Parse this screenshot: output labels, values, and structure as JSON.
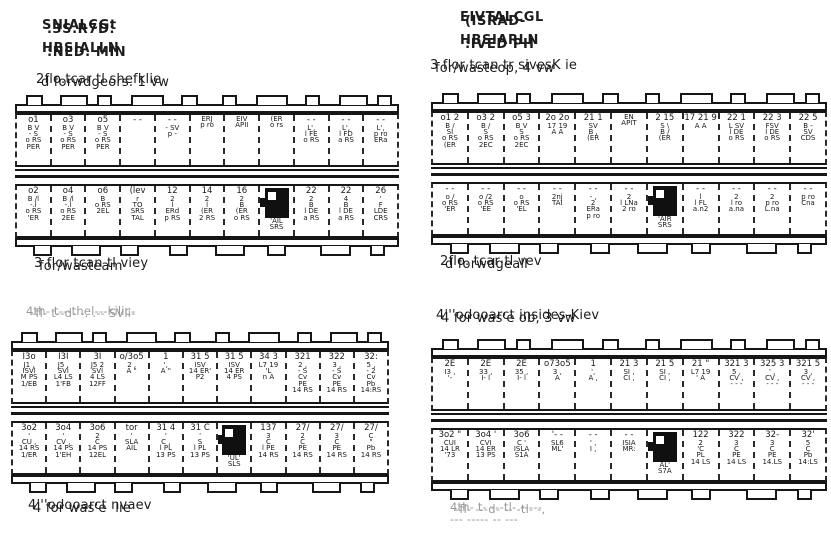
{
  "paper": "#ffffff",
  "ink": "#1c1c1c",
  "panels": [
    {
      "name": "upper-left",
      "header": [
        "SNIALCGt",
        ".3S.R7D:",
        "HBSIALLN",
        ":NED. MIN"
      ],
      "above": [
        "2flo.tcar tl shefklie",
        "d forwdgeors. 1 vw"
      ],
      "below": [
        "3 flor tcan tl viey",
        "for/wasteam"
      ],
      "rows": [
        [
          {
            "lines": [
              "o1",
              "B V",
              "- S",
              "o RS",
              "PER"
            ]
          },
          {
            "lines": [
              "o3",
              "B V",
              "- S",
              "o RS",
              "PER"
            ]
          },
          {
            "lines": [
              "o5",
              "B V",
              "- S",
              "o RS",
              "PER"
            ]
          },
          {
            "lines": [
              "- -"
            ]
          },
          {
            "lines": [
              "- -",
              "- SV",
              "p -"
            ]
          },
          {
            "lines": [
              "",
              "ERJ",
              "p ro"
            ]
          },
          {
            "lines": [
              "",
              "EIV",
              "APII"
            ]
          },
          {
            "lines": [
              "",
              "(ER",
              "o rs"
            ]
          },
          {
            "lines": [
              "- -",
              "L',",
              "l FE",
              "o RS"
            ]
          },
          {
            "lines": [
              "- -",
              "L',",
              "l FD",
              "a RS"
            ]
          },
          {
            "lines": [
              "- -",
              "L',",
              "p ro",
              "ERa"
            ]
          }
        ],
        [
          {
            "lines": [
              "o2",
              "B /l",
              "-.l",
              "o RS",
              "'ER"
            ]
          },
          {
            "lines": [
              "o4",
              "B /l",
              "-.l",
              "o RS",
              "2EE"
            ]
          },
          {
            "lines": [
              "o6",
              "B",
              "",
              "o RS",
              "2EL"
            ]
          },
          {
            "lines": [
              "(lev",
              "r",
              "TO",
              "SRS",
              "TAL"
            ]
          },
          {
            "lines": [
              "12",
              "2",
              "l",
              "ERd",
              "p RS"
            ]
          },
          {
            "lines": [
              "14",
              "2",
              "l",
              "(ER",
              "2 RS"
            ]
          },
          {
            "lines": [
              "16",
              "2",
              "B",
              "(ER",
              "o RS"
            ]
          },
          {
            "m": true,
            "lines": [
              "'AIL",
              "SRS"
            ]
          },
          {
            "lines": [
              "22",
              "2",
              "B",
              "l DE",
              "a RS"
            ]
          },
          {
            "lines": [
              "22",
              "4",
              "B",
              "l DE",
              "a RS"
            ]
          },
          {
            "lines": [
              "26",
              "'",
              "F",
              "LDE",
              "CRS"
            ]
          }
        ]
      ]
    },
    {
      "name": "upper-right",
      "header": [
        "EIVTALCGL",
        "(ISRAD-",
        "HBSIARLN",
        ":IVED PH"
      ],
      "above": [
        "3 flor tcan tr sivesK ie",
        "for/wasteop, 4 vw"
      ],
      "below": [
        "2flo. tcar tl vev",
        "d forwdgeall"
      ],
      "rows": [
        [
          {
            "lines": [
              "o1 2",
              "B /",
              "SI",
              "o RS",
              "(ER"
            ]
          },
          {
            "lines": [
              "o3 2",
              "B /",
              "S",
              "o RS",
              "2EC"
            ]
          },
          {
            "lines": [
              "o5 3",
              "B V",
              "S",
              "o RS",
              "2EC"
            ]
          },
          {
            "lines": [
              "2o 2o",
              "17 19",
              "A A"
            ]
          },
          {
            "lines": [
              "21 1",
              "SV",
              "B ,",
              "(ER"
            ]
          },
          {
            "lines": [
              "",
              "EN",
              "APIT"
            ]
          },
          {
            "lines": [
              "2 15",
              "S \\",
              "B /",
              "(ER"
            ]
          },
          {
            "lines": [
              "17 21 9",
              "A A"
            ]
          },
          {
            "lines": [
              "22 1",
              "L SV",
              "l DE",
              "o RS"
            ]
          },
          {
            "lines": [
              "22 3",
              "FSV",
              "l DE",
              "o RS"
            ]
          },
          {
            "lines": [
              "22 5",
              "B -",
              "SV",
              "CDS"
            ]
          }
        ],
        [
          {
            "lines": [
              "- -",
              "o /",
              "",
              "o RS",
              "'ER"
            ]
          },
          {
            "lines": [
              "- -",
              "o /2",
              "",
              "o RS",
              "'EE"
            ]
          },
          {
            "lines": [
              "- -",
              "o",
              "",
              "o RS",
              "'EL"
            ]
          },
          {
            "lines": [
              "- -",
              "",
              "2nj",
              "TAI"
            ]
          },
          {
            "lines": [
              "- -",
              "- ,",
              "2",
              "ERa",
              "p ro"
            ]
          },
          {
            "lines": [
              "- -",
              "2",
              "",
              "l LNa",
              "2 ro"
            ]
          },
          {
            "m": true,
            "lines": [
              "'AIR",
              "SRS"
            ]
          },
          {
            "lines": [
              "- -",
              "",
              "l",
              "l FL",
              "a.n2"
            ]
          },
          {
            "lines": [
              "- -",
              "",
              "2",
              "l ro",
              "a.na"
            ]
          },
          {
            "lines": [
              "- -",
              "",
              "2",
              "p ro",
              "L.na"
            ]
          },
          {
            "lines": [
              "- -",
              "",
              "",
              "p ro",
              "Cna"
            ]
          }
        ]
      ]
    },
    {
      "name": "lower-left",
      "header": null,
      "above": [
        "4th- t---thel---kilic-",
        "-fl- t--d- -. .-- SVli-"
      ],
      "below": [
        "4'''odooarct nvaev",
        "4 for was'e  lie"
      ],
      "rows": [
        [
          {
            "lines": [
              "I3o",
              "J1 ,",
              "ISVl",
              "M PS",
              "1/EB"
            ]
          },
          {
            "lines": [
              "I3I",
              "J5 ,",
              "SVl",
              "L4 LS",
              "1'FB"
            ]
          },
          {
            "lines": [
              "3I",
              "J5 2",
              "SVl",
              "4 LS",
              "12FF"
            ]
          },
          {
            "lines": [
              "o/3o5",
              "2 ,",
              "A \""
            ]
          },
          {
            "lines": [
              "1",
              "',",
              "A \""
            ]
          },
          {
            "lines": [
              "31 5",
              "ISV",
              "14 ER'",
              "P2"
            ]
          },
          {
            "lines": [
              "31 5",
              "ISV",
              "14 ER",
              "4 PS"
            ]
          },
          {
            "lines": [
              "34 3",
              "L7 19",
              "'L",
              "n A"
            ]
          },
          {
            "lines": [
              "321",
              "2 ,",
              "- S",
              "Cv",
              "PE",
              "14 RS"
            ]
          },
          {
            "lines": [
              "322",
              "3 ,",
              "- S",
              "Cv",
              "PE",
              "14 RS"
            ]
          },
          {
            "lines": [
              "32:",
              "5 ,",
              "- 2",
              "Cv",
              "Pb",
              "14:RS"
            ]
          }
        ],
        [
          {
            "lines": [
              "3o2",
              "'",
              "CU ,",
              "14 RS",
              "1/ER"
            ]
          },
          {
            "lines": [
              "3o4",
              "'",
              "CV ,",
              "14 PS",
              "1'EH"
            ]
          },
          {
            "lines": [
              "3o6",
              "2",
              "C",
              "14 PS",
              "12EL"
            ]
          },
          {
            "lines": [
              "tor",
              "'",
              "SLA",
              "AIL"
            ]
          },
          {
            "lines": [
              "31 4",
              "'",
              "C ,",
              "l PL",
              "13 PS"
            ]
          },
          {
            "lines": [
              "31 C",
              "'",
              "S",
              "l PL",
              "13 PS"
            ]
          },
          {
            "m": true,
            "lines": [
              "'UL'",
              "SLS"
            ]
          },
          {
            "lines": [
              "137",
              "3",
              "C",
              "l PE",
              "14 RS"
            ]
          },
          {
            "lines": [
              "27/",
              "2",
              "C",
              "PE",
              "14 RS"
            ]
          },
          {
            "lines": [
              "27/",
              "3",
              "C",
              "PE",
              "14 RS"
            ]
          },
          {
            "lines": [
              "27/",
              "C",
              "\"",
              "Pb",
              "14 RS"
            ]
          }
        ]
      ]
    },
    {
      "name": "lower-right",
      "header": null,
      "above": [
        "4'''odooarct insides-Kiev",
        "4 for was'e ob, 3 vw"
      ],
      "below": [
        "4th- t- ---tl- -----",
        "-fl- ---d- -- -tl- -,",
        "--- ----- -- ---"
      ],
      "rows": [
        [
          {
            "lines": [
              "2E",
              "I3 ,",
              "'-"
            ]
          },
          {
            "lines": [
              "2E",
              "33 ,",
              "I- l"
            ]
          },
          {
            "lines": [
              "2E",
              "35 ,",
              "I- l"
            ]
          },
          {
            "lines": [
              "o73o5",
              "3 ,",
              "A"
            ]
          },
          {
            "lines": [
              "1",
              "',",
              "A ,"
            ]
          },
          {
            "lines": [
              "21 3",
              "SI ,",
              "CI ,"
            ]
          },
          {
            "lines": [
              "21 5",
              "SI ,",
              "CI ,"
            ]
          },
          {
            "lines": [
              "21 \"",
              "L7 19",
              "' A"
            ]
          },
          {
            "lines": [
              "321 3",
              "5 ,",
              "CV ,",
              "- - -"
            ]
          },
          {
            "lines": [
              "325 3",
              "' ,",
              "CV ,",
              "- - -"
            ]
          },
          {
            "lines": [
              "321 5",
              "3 ,",
              "CV ,",
              "- - -"
            ]
          }
        ],
        [
          {
            "lines": [
              "3o2 \"",
              "CUI",
              "14 LR",
              "'73"
            ]
          },
          {
            "lines": [
              "3o4 '",
              "CVI",
              "14 ER",
              "13 PS"
            ]
          },
          {
            "lines": [
              "3o6",
              "C '",
              "ISLA",
              "S1A"
            ]
          },
          {
            "lines": [
              "'- -",
              "SL6",
              "ML'"
            ]
          },
          {
            "lines": [
              "- -",
              "' ,",
              "I ,"
            ]
          },
          {
            "lines": [
              "- -",
              "",
              "ISIA",
              "MR:"
            ]
          },
          {
            "m": true,
            "lines": [
              "AL'",
              "S7A"
            ]
          },
          {
            "lines": [
              "122",
              "2",
              "'C",
              "PL",
              "14 LS"
            ]
          },
          {
            "lines": [
              "322",
              "3",
              "C",
              "PE",
              "14 LS"
            ]
          },
          {
            "lines": [
              "32-",
              "3",
              "C",
              "PE",
              "14.LS"
            ]
          },
          {
            "lines": [
              "32'",
              "5",
              "C",
              "Pb",
              "14:LS"
            ]
          }
        ]
      ]
    }
  ]
}
